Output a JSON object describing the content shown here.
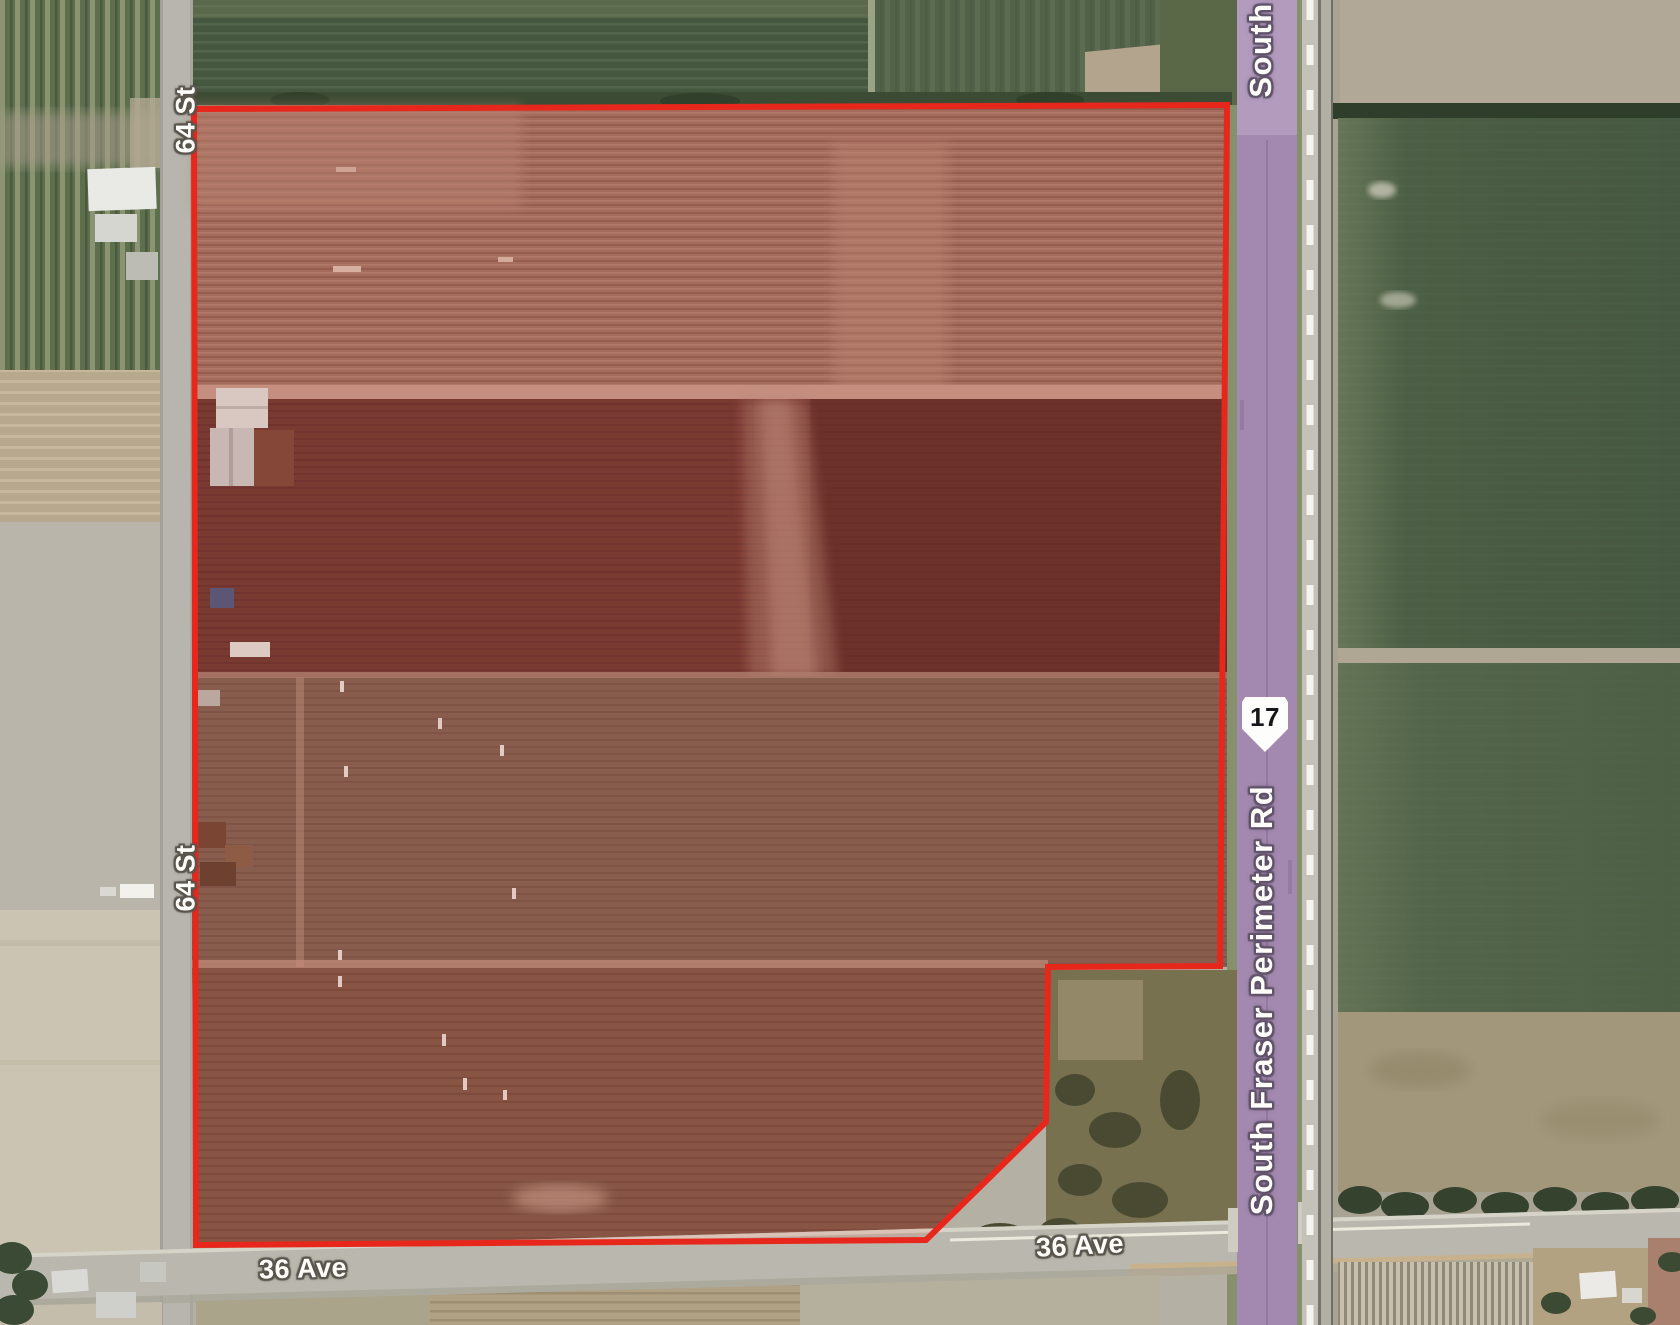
{
  "map": {
    "labels": {
      "street_64_top": "64 St",
      "street_64_mid": "64 St",
      "ave_36_west": "36 Ave",
      "ave_36_east": "36 Ave",
      "highway_name": "South Fraser Perimeter Rd",
      "highway_name_top_fragment": "South",
      "route_shield_number": "17"
    },
    "colors": {
      "parcel_boundary_red": "#e8271c",
      "highway_purple": "#a389af",
      "highway_purple_light": "#b59dc0",
      "road_gray": "#b9b7ae",
      "label_text": "#fdfcf8",
      "shield_background": "#fdfdfb",
      "shield_text": "#17171a",
      "field_green_dark": "#46573f",
      "field_green_right": "#4e6147",
      "parcel_band_top": "#9d7365",
      "parcel_band_dark": "#6d3b34",
      "parcel_band_olive": "#7d6354",
      "parcel_band_brown": "#7d5a49",
      "bare_field_gray": "#b9b5aa",
      "railway_gray": "#c3c1b8"
    }
  }
}
